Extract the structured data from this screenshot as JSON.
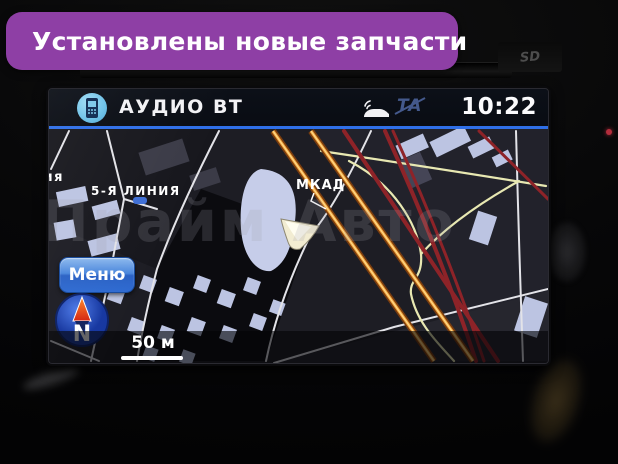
{
  "banner": {
    "label": "Установлены новые запчасти",
    "icon": "brake-disc-icon",
    "bg_color": "#8e3fa5"
  },
  "head_unit": {
    "sd_badge": "SD"
  },
  "nav_screen": {
    "status_bar": {
      "source": "АУДИО BT",
      "time": "10:22",
      "ta_badge": "TA",
      "icons": [
        "phone-icon",
        "car-traffic-icon",
        "ta-off-icon"
      ],
      "accent_color": "#2f6fe8"
    },
    "map": {
      "street_label_partial": "ния",
      "street_label": "5-Я ЛИНИЯ",
      "highway_label": "МКАД",
      "watermark": "Прайм Авто",
      "scale_label": "50 м",
      "menu_button_label": "Меню",
      "compass_letter": "N",
      "colors": {
        "highway": "#f0a43c",
        "traffic_jam": "#8e2328",
        "ramp": "#e8e8b2",
        "road": "#e3e3e8",
        "building": "#bcc4e2"
      }
    }
  }
}
